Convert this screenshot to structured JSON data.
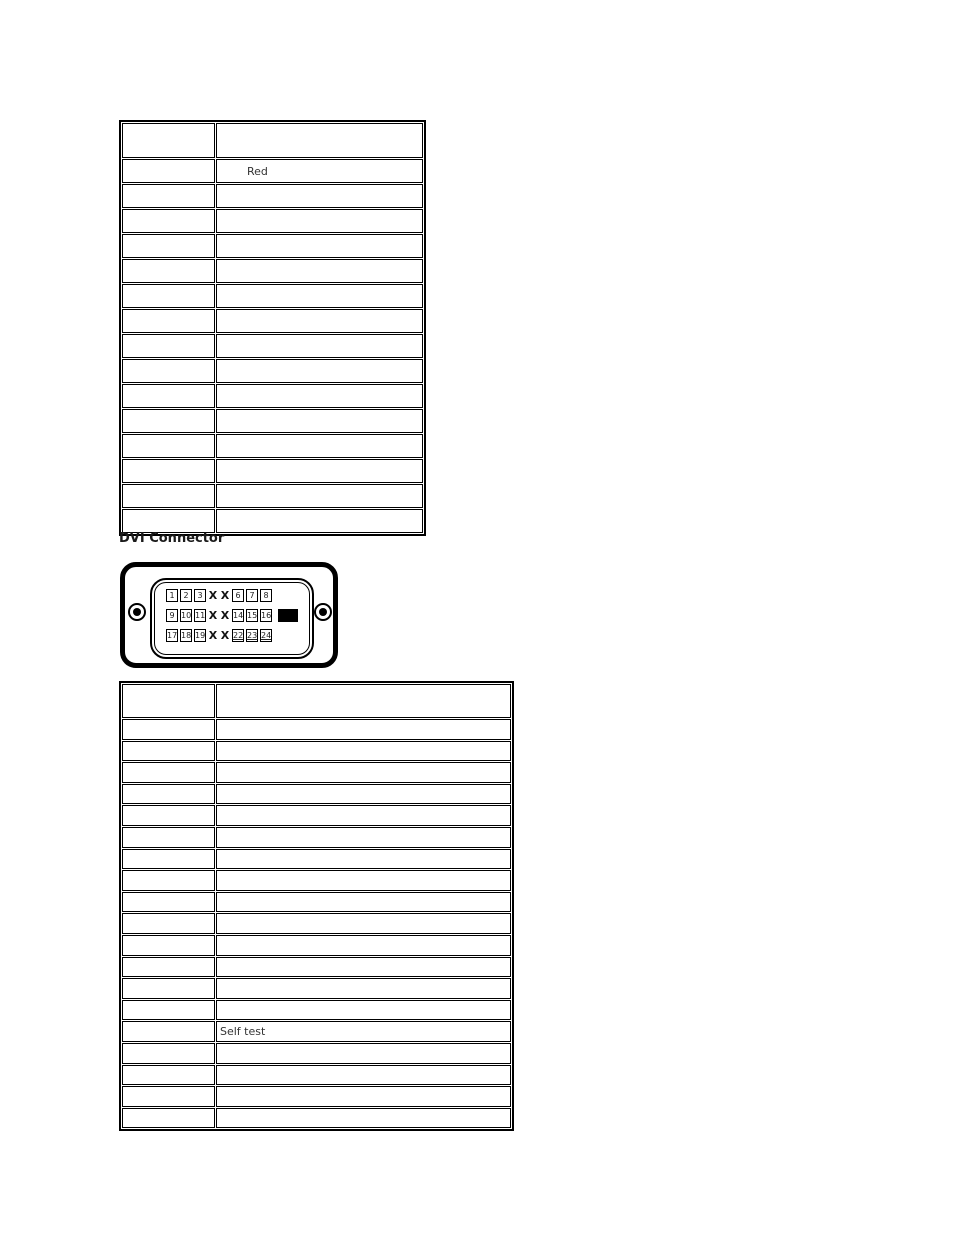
{
  "heading": {
    "text": "DVI Connector"
  },
  "colors": {
    "page_background": "#ffffff",
    "table_border": "#000000",
    "cell_text": "#333333",
    "heading_text": "#1a1a1a",
    "diagram_outline": "#000000"
  },
  "upper_table": {
    "header": [
      "",
      ""
    ],
    "rows": [
      [
        "",
        "Red"
      ],
      [
        "",
        ""
      ],
      [
        "",
        ""
      ],
      [
        "",
        ""
      ],
      [
        "",
        ""
      ],
      [
        "",
        ""
      ],
      [
        "",
        ""
      ],
      [
        "",
        ""
      ],
      [
        "",
        ""
      ],
      [
        "",
        ""
      ],
      [
        "",
        ""
      ],
      [
        "",
        ""
      ],
      [
        "",
        ""
      ],
      [
        "",
        ""
      ],
      [
        "",
        ""
      ]
    ]
  },
  "dvi_table": {
    "header": [
      "",
      ""
    ],
    "rows": [
      [
        "",
        ""
      ],
      [
        "",
        ""
      ],
      [
        "",
        ""
      ],
      [
        "",
        ""
      ],
      [
        "",
        ""
      ],
      [
        "",
        ""
      ],
      [
        "",
        ""
      ],
      [
        "",
        ""
      ],
      [
        "",
        ""
      ],
      [
        "",
        ""
      ],
      [
        "",
        ""
      ],
      [
        "",
        ""
      ],
      [
        "",
        ""
      ],
      [
        "",
        ""
      ],
      [
        "",
        "Self test"
      ],
      [
        "",
        ""
      ],
      [
        "",
        ""
      ],
      [
        "",
        ""
      ],
      [
        "",
        ""
      ]
    ]
  },
  "dvi_diagram": {
    "rows": [
      {
        "pins_left": [
          "1",
          "2",
          "3"
        ],
        "no_pin_marks": [
          "X",
          "X"
        ],
        "pins_right": [
          "6",
          "7",
          "8"
        ]
      },
      {
        "pins_left": [
          "9",
          "10",
          "11"
        ],
        "no_pin_marks": [
          "X",
          "X"
        ],
        "pins_right": [
          "14",
          "15",
          "16"
        ],
        "blade_slot": true
      },
      {
        "pins_left": [
          "17",
          "18",
          "19"
        ],
        "no_pin_marks": [
          "X",
          "X"
        ],
        "pins_right": [
          "22",
          "23",
          "24"
        ]
      }
    ]
  }
}
